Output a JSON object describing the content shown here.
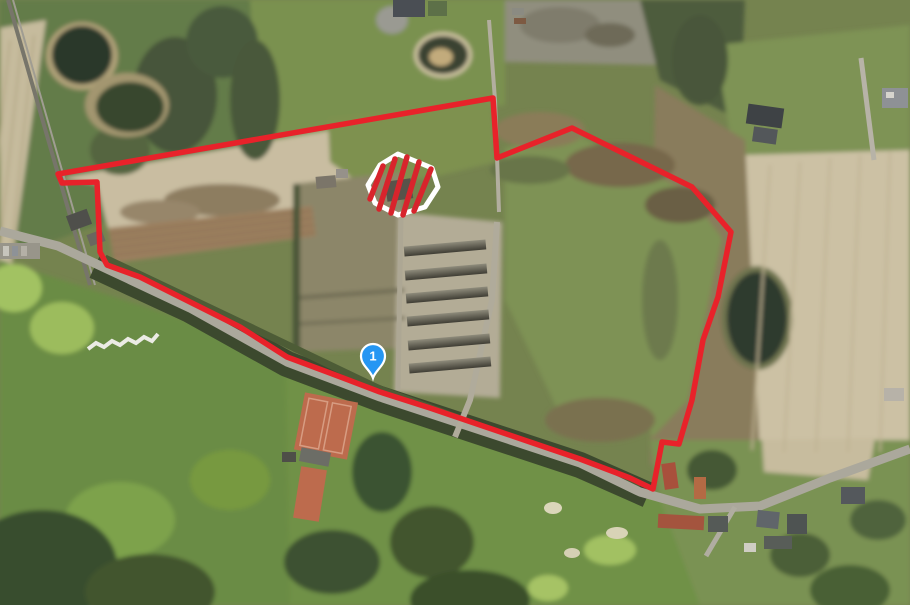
{
  "map": {
    "view_type": "satellite-aerial",
    "marker": {
      "label": "1",
      "color": "#2596f3",
      "outline": "#ffffff"
    },
    "boundary": {
      "color": "#e8222a"
    },
    "restricted_area": {
      "stripe_color": "#d8242c",
      "border_color": "#ffffff"
    }
  }
}
